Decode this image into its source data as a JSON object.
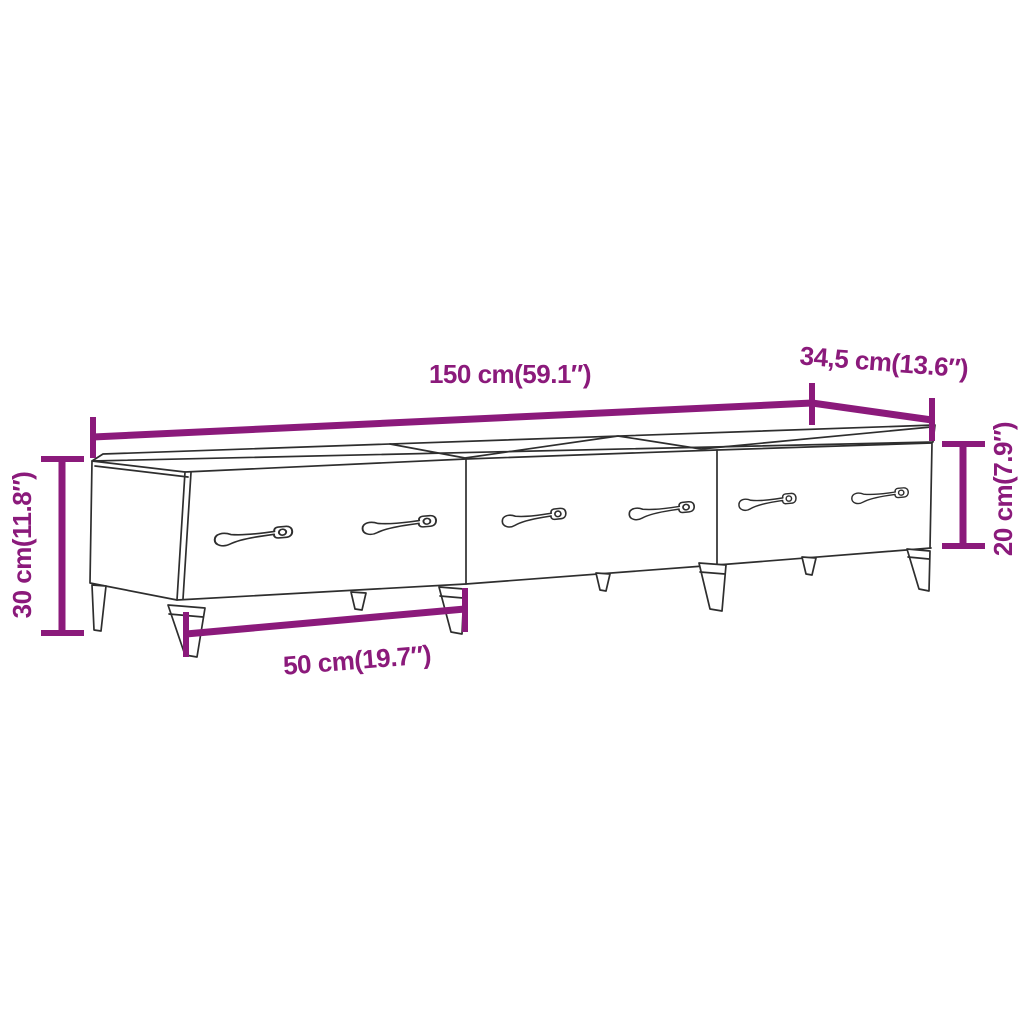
{
  "diagram": {
    "type": "product-dimension-diagram",
    "product": "tv-cabinet-3-drawers",
    "labels": {
      "width": "150 cm(59.1″)",
      "depth": "34,5 cm(13.6″)",
      "height": "30 cm(11.8″)",
      "front_height": "20 cm(7.9″)",
      "drawer_width": "50 cm(19.7″)"
    },
    "dimensions": {
      "width_cm": "150",
      "width_in": "59.1",
      "depth_cm": "34,5",
      "depth_in": "13.6",
      "height_cm": "30",
      "height_in": "11.8",
      "front_height_cm": "20",
      "front_height_in": "7.9",
      "drawer_width_cm": "50",
      "drawer_width_in": "19.7"
    },
    "counts": {
      "drawers": 3,
      "handles": 6,
      "legs_visible": 8
    },
    "colors": {
      "accent": "#8b1a7b",
      "line": "#2e2e2e",
      "background": "#ffffff"
    }
  }
}
